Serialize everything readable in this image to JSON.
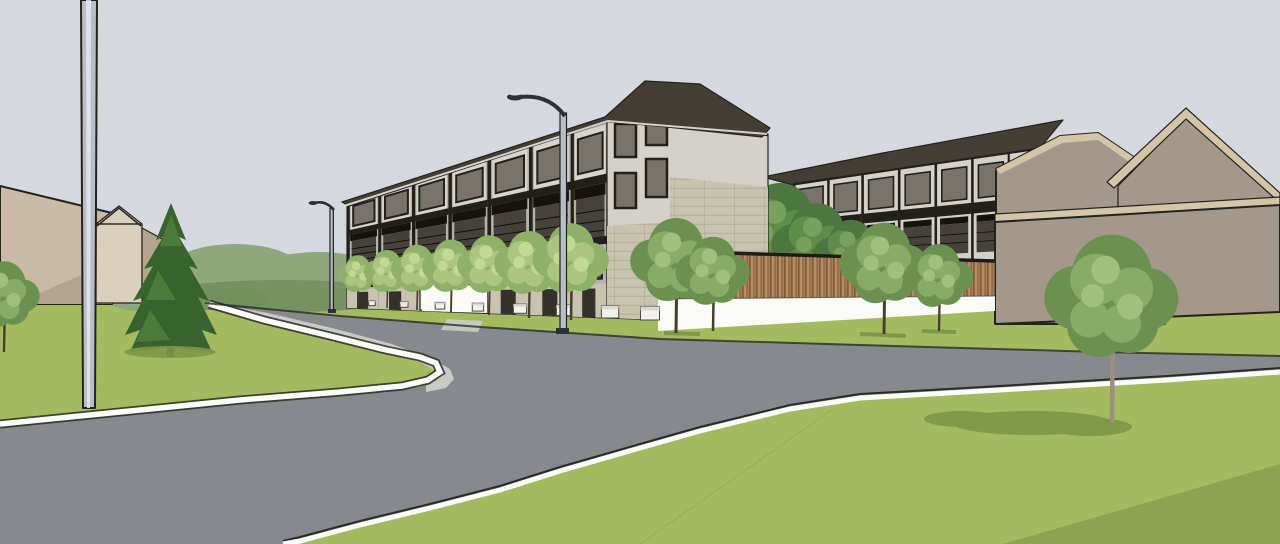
{
  "scene": {
    "description": "3D architectural massing rendering (SketchUp-style) of a four-storey townhouse/apartment development seen from a curving suburban street, with a wood-and-white privacy fence, street trees, lawns, street lights, a tall utility pole and beige context building masses.",
    "visible_text": "none"
  },
  "palette": {
    "sky": "#d6d8e0",
    "road": "#868a8e",
    "sidewalk": "#c9cac6",
    "curbWhite": "#fbfbf8",
    "lineDark": "#2b2b27",
    "grass": "#a3ba5f",
    "grassDark": "#8da34f",
    "shadowGreen": "#7e9849",
    "grassLine": "#97ac57",
    "tanWall": "#cbbaa3",
    "tanShade": "#b4a48d",
    "tanGable": "#dacfbb",
    "tanWall2": "#a3988a",
    "tanRoof": "#d4c5a9",
    "roofDark": "#443e36",
    "fascia": "#e7e3da",
    "sidingLight": "#d7d4cd",
    "sidingMid": "#b4b1aa",
    "sidingFace": "#d3d1ca",
    "frameDark": "#22201b",
    "awning": "#15130e",
    "balcony": "#46423b",
    "railDark": "#110f0b",
    "glassDark": "#4c4840",
    "glassMid": "#79736b",
    "stone": "#c7c3ae",
    "stoneLine": "#ada993",
    "doorDark": "#34312b",
    "fenceWhite": "#fafaf7",
    "woodBase": "#a87f57",
    "woodDark": "#7e5c3c",
    "woodMid": "#936b45",
    "woodLight": "#c09568",
    "fenceCap": "#1f1c16",
    "poleGray": "#b7bec8",
    "poleHi": "#e4e9f0",
    "lampDark": "#2c3137",
    "lampHead": "#d8dce2",
    "trunk": "#4a3f2e",
    "trunkLight": "#9a8f80",
    "conifer": "#38632f",
    "coniferHi": "#54813f",
    "coniferTrunk": "#2e281d",
    "bgTree": "#8fa77c",
    "bgTreeDark": "#73905f",
    "white": "#f2f1ec",
    "planterTop": "#d9d7cf",
    "whiteWall": "#f4f3ee"
  },
  "tones": {
    "light": {
      "b": "#8fb069",
      "l": "#a9c57f",
      "h": "#c2d996"
    },
    "mid": {
      "b": "#6a9150",
      "l": "#87ac67",
      "h": "#a0c17d"
    },
    "dark": {
      "b": "#4c7740",
      "l": "#618c4c",
      "h": "#78a05e"
    }
  },
  "scene_geometry": {
    "main_facade": {
      "x0": 347,
      "x1": 607,
      "top0": 202,
      "top1": 120,
      "bot0": 308,
      "bot1": 318,
      "bays": [
        0,
        0.12,
        0.25,
        0.39,
        0.54,
        0.7,
        0.86,
        1
      ]
    },
    "bg_facade": {
      "x0": 793,
      "x1": 1037,
      "top0": 183,
      "top1": 148,
      "bot0": 273,
      "bot1": 263,
      "bays": [
        0,
        0.14,
        0.28,
        0.43,
        0.58,
        0.73,
        0.88,
        1
      ]
    },
    "trees": {
      "street": [
        {
          "x": 358,
          "b": 306,
          "s": 0.42
        },
        {
          "x": 387,
          "b": 308,
          "s": 0.48
        },
        {
          "x": 417,
          "b": 310,
          "s": 0.54
        },
        {
          "x": 451,
          "b": 312,
          "s": 0.6
        },
        {
          "x": 489,
          "b": 315,
          "s": 0.66
        },
        {
          "x": 529,
          "b": 318,
          "s": 0.72
        },
        {
          "x": 571,
          "b": 320,
          "s": 0.8
        }
      ],
      "fence_front": [
        {
          "x": 676,
          "b": 333,
          "s": 0.95
        },
        {
          "x": 713,
          "b": 331,
          "s": 0.78
        },
        {
          "x": 884,
          "b": 334,
          "s": 0.92
        },
        {
          "x": 939,
          "b": 331,
          "s": 0.72
        }
      ],
      "fence_back": [
        {
          "x": 780,
          "b": 322,
          "s": 1.15,
          "tone": "dark"
        },
        {
          "x": 817,
          "b": 318,
          "s": 0.95,
          "tone": "dark"
        },
        {
          "x": 851,
          "b": 314,
          "s": 0.78,
          "tone": "dark"
        }
      ],
      "edge_left": [
        {
          "x": 4,
          "b": 352,
          "s": 0.75
        }
      ],
      "foreground": [
        {
          "x": 1112,
          "b": 423,
          "s": 1.4,
          "t": 50,
          "tone": "mid",
          "tc": "#9a8f80"
        }
      ]
    },
    "planters": [
      372,
      404,
      440,
      478,
      520,
      564,
      610,
      650
    ]
  }
}
